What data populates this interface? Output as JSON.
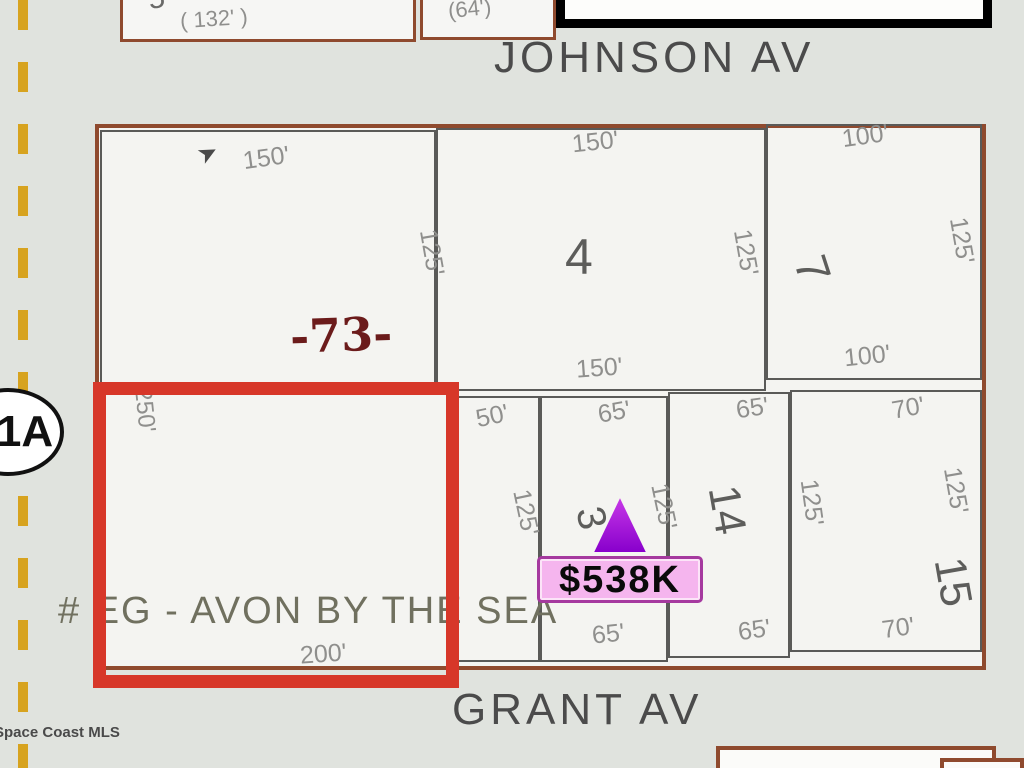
{
  "streets": {
    "top_label": "JOHNSON AV",
    "bottom_label": "GRANT AV"
  },
  "adjacent_parcels": {
    "top_left_number": "5",
    "top_left_dim": "( 132' )",
    "top_mid_dim": "(64')"
  },
  "block73": {
    "number": "-73-",
    "top_dim": "150'",
    "right_dim": "125'"
  },
  "lot4": {
    "number": "4",
    "top_dim": "150'",
    "right_dim": "125'",
    "bottom_dim": "150'"
  },
  "lot7": {
    "number": "7",
    "top_dim": "100'",
    "right_dim": "125'",
    "bottom_dim": "100'"
  },
  "selected_parcel": {
    "left_dim": "250'",
    "bottom_dim": "200'",
    "overlay_text": "# EG - AVON BY THE SEA"
  },
  "strip_lot": {
    "top_dim": "50'",
    "side_dim": "125'"
  },
  "lot3": {
    "number": "3",
    "top_dim": "65'",
    "right_dim": "125'",
    "bottom_dim": "65'"
  },
  "lot14": {
    "number": "14",
    "top_dim": "65'",
    "right_dim": "125'",
    "bottom_dim": "65'"
  },
  "lot15": {
    "number": "15",
    "top_dim": "70'",
    "right_dim": "125'",
    "bottom_dim": "70'"
  },
  "marker": {
    "price": "$538K"
  },
  "route_oval": {
    "label": "1A"
  },
  "watermark": "Space Coast MLS",
  "colors": {
    "selected_outline": "#d73729",
    "marker_fill": "#9b10dc",
    "price_bubble_bg": "#f5b5ee",
    "price_bubble_border": "#a5399f",
    "parcel_border": "#8f4a2e",
    "lot_line": "#5a5a58",
    "dashed_centerline": "#d7a31f"
  }
}
